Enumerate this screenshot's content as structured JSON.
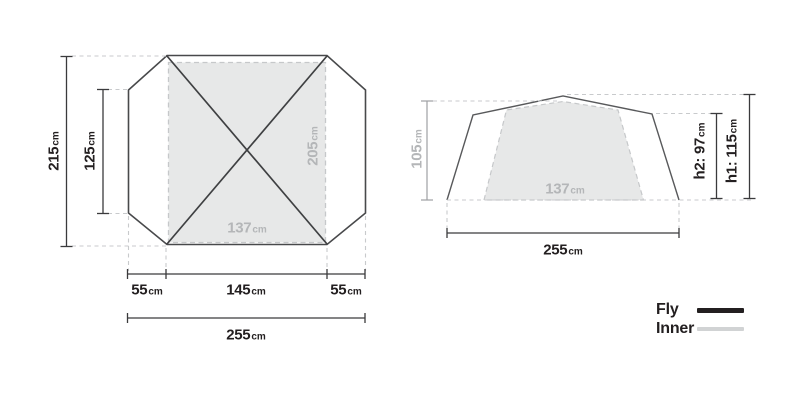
{
  "top_view": {
    "total_depth": {
      "value": "215",
      "unit": "cm"
    },
    "inner_depth": {
      "value": "125",
      "unit": "cm"
    },
    "inner_length": {
      "value": "205",
      "unit": "cm"
    },
    "inner_width": {
      "value": "137",
      "unit": "cm"
    },
    "left_porch": {
      "value": "55",
      "unit": "cm"
    },
    "floor_length": {
      "value": "145",
      "unit": "cm"
    },
    "right_porch": {
      "value": "55",
      "unit": "cm"
    },
    "total_width": {
      "value": "255",
      "unit": "cm"
    }
  },
  "side_view": {
    "inner_height": {
      "value": "105",
      "unit": "cm"
    },
    "inner_width": {
      "value": "137",
      "unit": "cm"
    },
    "total_width": {
      "value": "255",
      "unit": "cm"
    },
    "h2": {
      "value": "h2: 97",
      "unit": "cm"
    },
    "h1": {
      "value": "h1: 115",
      "unit": "cm"
    }
  },
  "legend": {
    "fly": {
      "label": "Fly",
      "color": "#231f20"
    },
    "inner": {
      "label": "Inner",
      "color": "#d1d3d4"
    }
  },
  "colors": {
    "fly_outline_top": "#48494b",
    "fly_outline_side": "#58595b",
    "pole": "#3f4042",
    "dim_dark": "#3a3a3c",
    "dim_gray": "#9ea0a3",
    "guide_dashed": "#c8cacc",
    "inner_fill": "#e7e8e8",
    "inner_stroke": "#c6c8ca",
    "text_dark": "#231f20",
    "text_gray": "#b4b6b8"
  }
}
